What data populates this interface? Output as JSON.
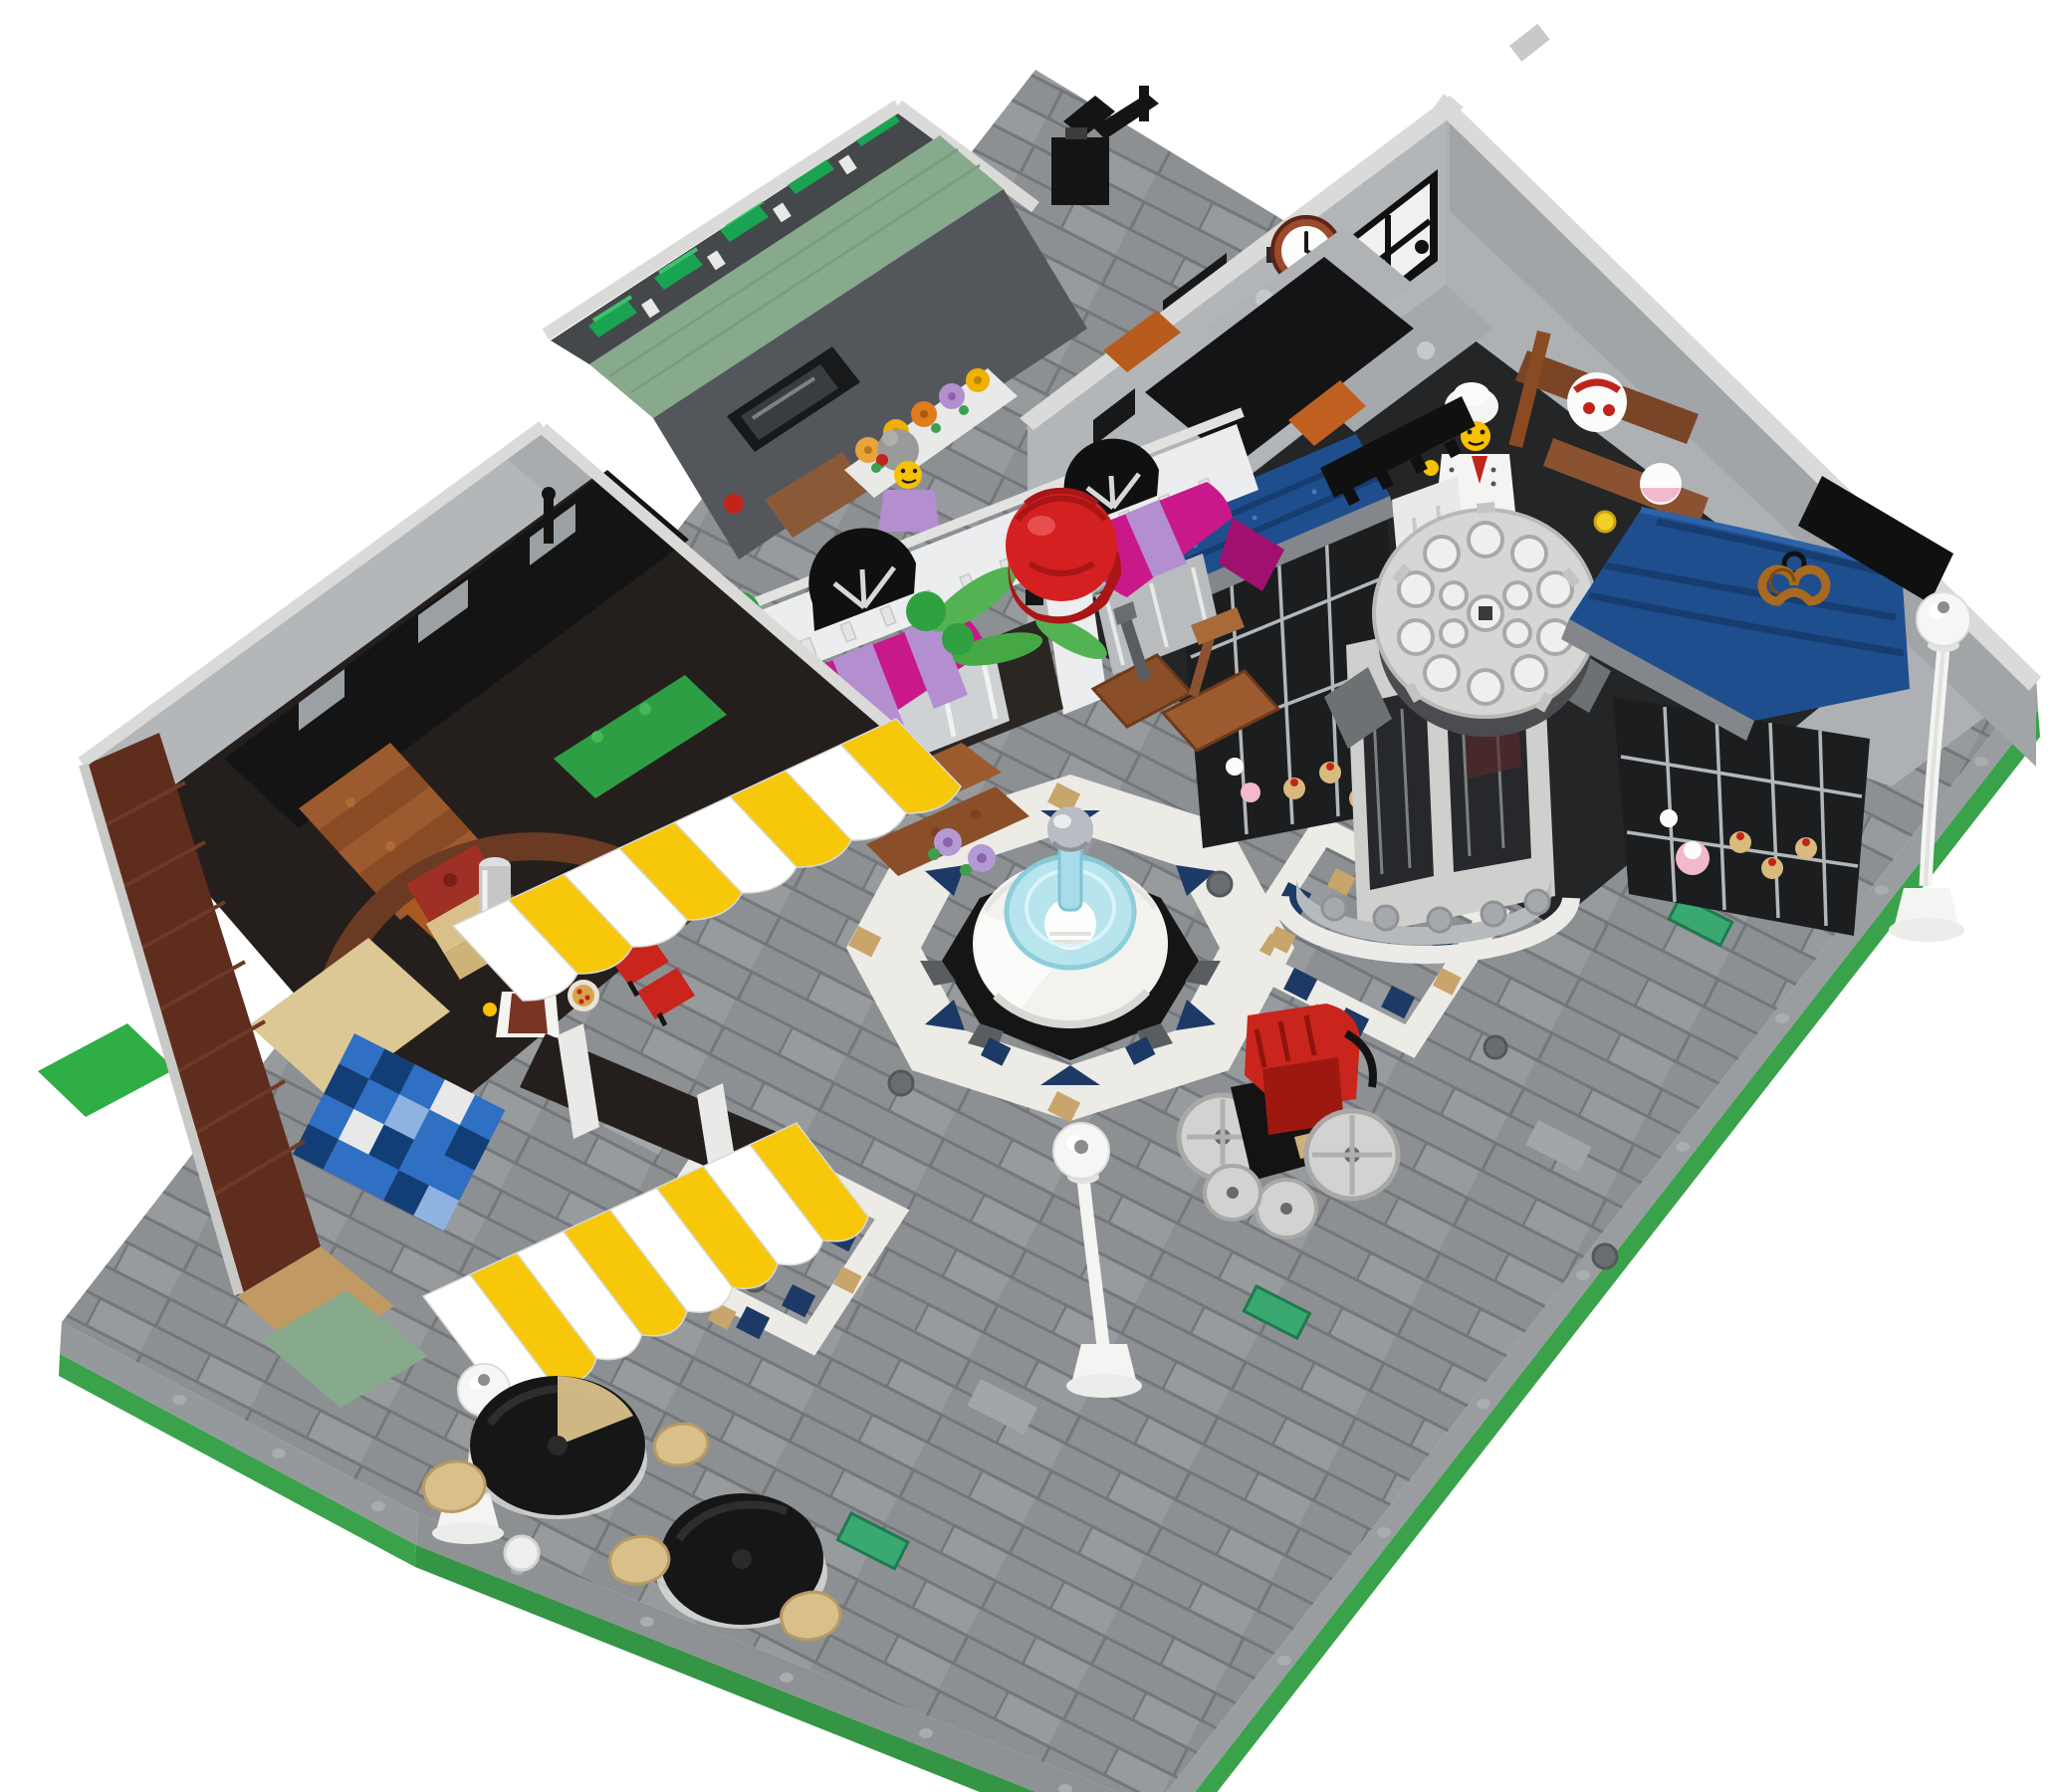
{
  "scene": {
    "type": "product-photo",
    "subject": "LEGO modular-building town square with bakery, florist and pizzeria-cafe around a tiled plaza",
    "view": "elevated three-quarter aerial view on seamless white background",
    "background": "#ffffff"
  },
  "palette": {
    "plaza_tile": "#8d9093",
    "plaza_gap": "#73767a",
    "plaza_light": "#a3a6a9",
    "path_white": "#edebe6",
    "accent_navy": "#1d3a66",
    "accent_tan": "#c8a56b",
    "side_gray": "#96999c",
    "baseplate_green": "#3aa24b",
    "wall_gray": "#b3b6b9",
    "wall_gray_dark": "#a2a5a8",
    "rail_white": "#dadad8",
    "sand_green": "#87a98c",
    "window_green": "#1aa351",
    "brick_brown": "#5e2d1e",
    "brick_tan": "#c09a62",
    "interior_dark": "#242120",
    "stair_brown": "#9c5a2e",
    "checker_blue": "#2f6fc4",
    "checker_navy": "#123e78",
    "awning_blue": "#1f4e8e",
    "awning_blue_dark": "#173c6f",
    "awning_yellow": "#f7c80a",
    "awning_white": "#ffffff",
    "awning_magenta": "#c9188a",
    "awning_lavender": "#b48fd0",
    "facade_white": "#ecedee",
    "rose_red": "#d42020",
    "leaf_green": "#33a23d",
    "fountain_white": "#f3f2ee",
    "fountain_glass": "#b5e4ee",
    "fountain_black": "#151515",
    "silver": "#b9bcc2",
    "lamp_white": "#f4f4f2",
    "pram_red": "#c9251c",
    "wheel_gray": "#d2d2d0",
    "table_black": "#161616",
    "chair_tan": "#d9c08a",
    "minifig_yellow": "#f7c100",
    "chef_white": "#f4f4f2",
    "scarf_red": "#c0251c",
    "clock_rim": "#9c4a2e",
    "clock_face": "#fdfdfb",
    "crate_brown": "#8a4f28",
    "tile_teal": "#3aa871",
    "cake_pink": "#f2b8cc",
    "cone_tan": "#d8b97e"
  },
  "objects": {
    "clock": {
      "time_shown": "approx 1:50"
    },
    "minifigures": [
      {
        "id": "baker-chef",
        "location": "bakery interior (top right)",
        "outfit": "white toque, white chef jacket, red neckerchief"
      },
      {
        "id": "pizza-chef",
        "location": "pizzeria counter (left)",
        "outfit": "black hair, glasses, white jacket, dark red apron"
      },
      {
        "id": "florist-grandma",
        "location": "florist upper room (center)",
        "outfit": "gray hair bun, lavender top"
      }
    ],
    "street_lamps": {
      "count": 3
    },
    "cafe_tables": {
      "count": 2,
      "chairs": 4
    },
    "awnings": {
      "yellow_striped": 2,
      "dark_blue": 2,
      "magenta_lavender": 2
    },
    "signs": [
      "hanging red rose (florist)",
      "hanging pretzel (bakery)"
    ],
    "fountain": {
      "parts": "black octagonal base, white dome basin, trans-blue glass ring, trans-blue column, chrome-silver sphere finial",
      "surround": "white octagonal tile ring with navy triangles and tan accents"
    },
    "plaza_decor": [
      "two navy-and-tan tile diamonds",
      "scattered teal 1x2 tiles",
      "round utility studs",
      "round rose-window disc on bay rotunda",
      "red pram with gray wheels"
    ],
    "buildings": [
      {
        "id": "bakery",
        "walls": "light gray",
        "features": "wall clock, white panel door, black oven, cake shelf, blue awnings, lattice display windows with pastries, bay rotunda with round disc window, black camera rig on wall top"
      },
      {
        "id": "florist",
        "walls": "sand green with trans-green clerestory strip",
        "features": "white arched colonnade, rose sign, magenta awnings, flower stall tables, tool crates, green tree foliage"
      },
      {
        "id": "pizzeria-cafe",
        "walls": "dark reddish-brown brick over tan and sand-green base",
        "features": "brick arch, staircase, pizza oven, cash register, blue checker floor, yellow-white scalloped awnings, outdoor black tables with tan chairs"
      }
    ]
  }
}
